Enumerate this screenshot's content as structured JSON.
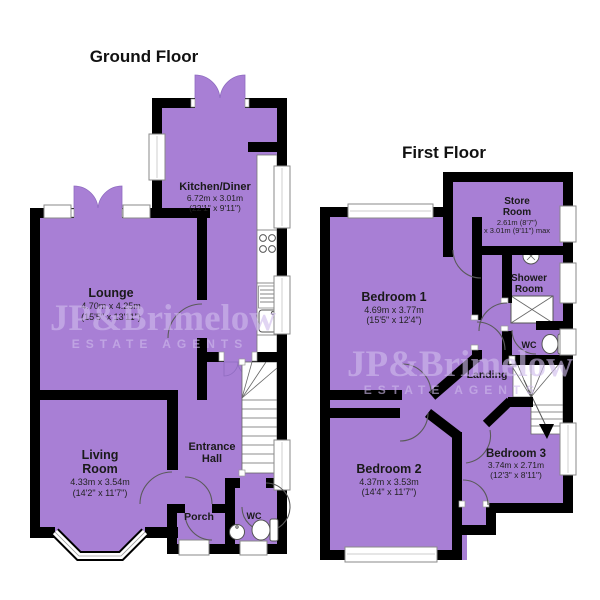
{
  "colors": {
    "room_fill": "#A87FD5",
    "petal_edge": "#8F6CC0",
    "wall": "#000000",
    "watermark": "#CFBCEB",
    "label": "#1A1A1A"
  },
  "watermark": {
    "brand": "JP&Brimelow",
    "tagline": "ESTATE AGENTS"
  },
  "ground_floor": {
    "title": "Ground Floor",
    "kitchen": {
      "name": "Kitchen/Diner",
      "metric": "6.72m x 3.01m",
      "imperial": "(22'1\" x 9'11\")"
    },
    "lounge": {
      "name": "Lounge",
      "metric": "4.70m x 4.25m",
      "imperial": "(15'5\" x 13'11\")"
    },
    "living": {
      "name_line1": "Living",
      "name_line2": "Room",
      "metric": "4.33m x 3.54m",
      "imperial": "(14'2\" x 11'7\")"
    },
    "entrance": {
      "name_line1": "Entrance",
      "name_line2": "Hall"
    },
    "porch": {
      "name": "Porch"
    },
    "wc": {
      "name": "WC"
    }
  },
  "first_floor": {
    "title": "First Floor",
    "store": {
      "name_line1": "Store",
      "name_line2": "Room",
      "metric": "2.61m (8'7\")",
      "metric2": "x 3.01m (9'11\") max"
    },
    "shower": {
      "name_line1": "Shower",
      "name_line2": "Room"
    },
    "bedroom1": {
      "name": "Bedroom 1",
      "metric": "4.69m x 3.77m",
      "imperial": "(15'5\" x 12'4\")"
    },
    "wc": {
      "name": "WC"
    },
    "landing": {
      "name": "Landing"
    },
    "bedroom2": {
      "name": "Bedroom 2",
      "metric": "4.37m x 3.53m",
      "imperial": "(14'4\" x 11'7\")"
    },
    "bedroom3": {
      "name": "Bedroom 3",
      "metric": "3.74m x 2.71m",
      "imperial": "(12'3\" x 8'11\")"
    }
  }
}
